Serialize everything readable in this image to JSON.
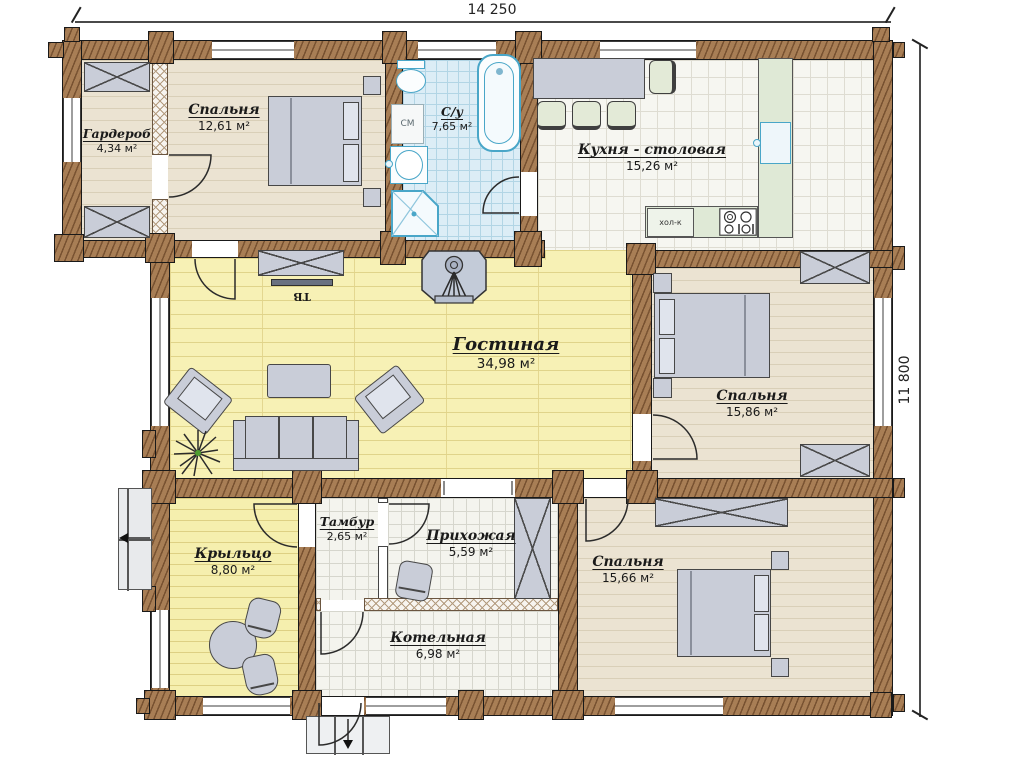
{
  "dimensions": {
    "width_label": "14 250",
    "height_label": "11 800"
  },
  "rooms": [
    {
      "id": "wardrobe",
      "name": "Гардероб",
      "area": "4,34 м²"
    },
    {
      "id": "bedroom1",
      "name": "Спальня",
      "area": "12,61 м²"
    },
    {
      "id": "bathroom",
      "name": "С/у",
      "area": "7,65 м²"
    },
    {
      "id": "kitchen",
      "name": "Кухня - столовая",
      "area": "15,26 м²"
    },
    {
      "id": "living",
      "name": "Гостиная",
      "area": "34,98 м²"
    },
    {
      "id": "bedroom2",
      "name": "Спальня",
      "area": "15,86 м²"
    },
    {
      "id": "porch",
      "name": "Крыльцо",
      "area": "8,80 м²"
    },
    {
      "id": "vestibule",
      "name": "Тамбур",
      "area": "2,65 м²"
    },
    {
      "id": "hallway",
      "name": "Прихожая",
      "area": "5,59 м²"
    },
    {
      "id": "boiler",
      "name": "Котельная",
      "area": "6,98 м²"
    },
    {
      "id": "bedroom3",
      "name": "Спальня",
      "area": "15,66 м²"
    }
  ],
  "labels": {
    "tv": "ТВ",
    "washing_machine": "СМ",
    "fridge": "хол-к"
  },
  "colors": {
    "wall": "#a87e55",
    "floor_beige": "#ebe3d2",
    "floor_plank": "#f7f1b5",
    "tile_white": "#f4f4ee",
    "tile_blue": "#dcedf6",
    "furniture": "#c9cdd8",
    "counter_green": "#dfe9d6",
    "fixture_outline": "#49a6c8",
    "plant_green": "#4f9e2f",
    "text": "#1a1a1a"
  }
}
